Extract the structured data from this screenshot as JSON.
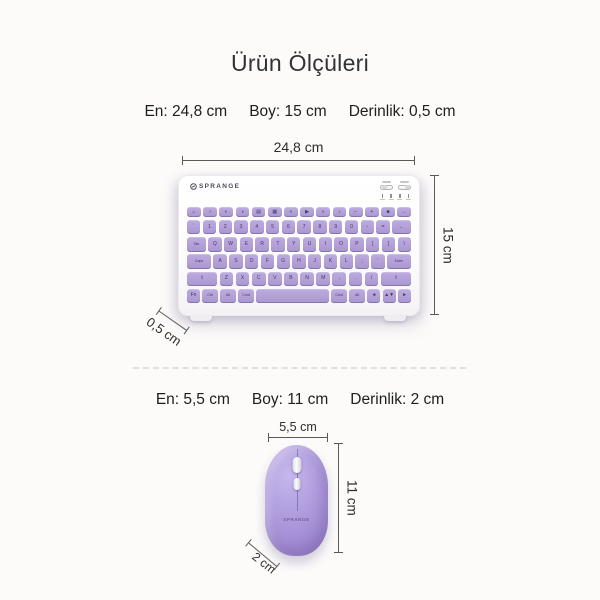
{
  "page": {
    "title": "Ürün Ölçüleri",
    "background": "#fcfbfa"
  },
  "keyboard_section": {
    "specs": [
      {
        "label": "En: 24,8 cm"
      },
      {
        "label": "Boy: 15 cm"
      },
      {
        "label": "Derinlik: 0,5 cm"
      }
    ],
    "width_label": "24,8 cm",
    "height_label": "15 cm",
    "depth_label": "0,5 cm",
    "brand": "SPRANGE",
    "key_rows": [
      {
        "fn": true,
        "keys": [
          [
            "⌂",
            1
          ],
          [
            "○",
            1
          ],
          [
            "◐",
            1
          ],
          [
            "◑",
            1
          ],
          [
            "▤",
            1
          ],
          [
            "▦",
            1
          ],
          [
            "«",
            1
          ],
          [
            "▶",
            1
          ],
          [
            "»",
            1
          ],
          [
            "♪",
            1
          ],
          [
            "−",
            1
          ],
          [
            "+",
            1
          ],
          [
            "■",
            1
          ],
          [
            "←",
            1
          ]
        ]
      },
      {
        "keys": [
          [
            "`",
            1
          ],
          [
            "1",
            1
          ],
          [
            "2",
            1
          ],
          [
            "3",
            1
          ],
          [
            "4",
            1
          ],
          [
            "5",
            1
          ],
          [
            "6",
            1
          ],
          [
            "7",
            1
          ],
          [
            "8",
            1
          ],
          [
            "9",
            1
          ],
          [
            "0",
            1
          ],
          [
            "-",
            1
          ],
          [
            "=",
            1
          ],
          [
            "←",
            1.4
          ]
        ]
      },
      {
        "keys": [
          [
            "Tab",
            1.4
          ],
          [
            "Q",
            1
          ],
          [
            "W",
            1
          ],
          [
            "E",
            1
          ],
          [
            "R",
            1
          ],
          [
            "T",
            1
          ],
          [
            "Y",
            1
          ],
          [
            "U",
            1
          ],
          [
            "I",
            1
          ],
          [
            "O",
            1
          ],
          [
            "P",
            1
          ],
          [
            "[",
            1
          ],
          [
            "]",
            1
          ],
          [
            "\\",
            1
          ]
        ]
      },
      {
        "keys": [
          [
            "Caps",
            1.8
          ],
          [
            "A",
            1
          ],
          [
            "S",
            1
          ],
          [
            "D",
            1
          ],
          [
            "F",
            1
          ],
          [
            "G",
            1
          ],
          [
            "H",
            1
          ],
          [
            "J",
            1
          ],
          [
            "K",
            1
          ],
          [
            "L",
            1
          ],
          [
            ";",
            1
          ],
          [
            "'",
            1
          ],
          [
            "Enter",
            1.8
          ]
        ]
      },
      {
        "keys": [
          [
            "⇧",
            2.2
          ],
          [
            "Z",
            1
          ],
          [
            "X",
            1
          ],
          [
            "C",
            1
          ],
          [
            "V",
            1
          ],
          [
            "B",
            1
          ],
          [
            "N",
            1
          ],
          [
            "M",
            1
          ],
          [
            ",",
            1
          ],
          [
            ".",
            1
          ],
          [
            "/",
            1
          ],
          [
            "⇧",
            2.2
          ]
        ]
      },
      {
        "keys": [
          [
            "Fn",
            1
          ],
          [
            "Ctrl",
            1.2
          ],
          [
            "Alt",
            1.2
          ],
          [
            "Cmd",
            1.2
          ],
          [
            "",
            5.6
          ],
          [
            "Cmd",
            1.2
          ],
          [
            "Alt",
            1.2
          ],
          [
            "◄",
            1
          ],
          [
            "▲▼",
            1
          ],
          [
            "►",
            1
          ]
        ]
      }
    ]
  },
  "mouse_section": {
    "specs": [
      {
        "label": "En: 5,5 cm"
      },
      {
        "label": "Boy: 11 cm"
      },
      {
        "label": "Derinlik: 2 cm"
      }
    ],
    "width_label": "5,5 cm",
    "height_label": "11 cm",
    "depth_label": "2 cm",
    "brand": "SPRANGE"
  },
  "colors": {
    "key_purple": "#b2a0d7",
    "mouse_purple": "#ae99de",
    "dimension_line": "#5a5a5a",
    "text": "#1e1e1e"
  }
}
